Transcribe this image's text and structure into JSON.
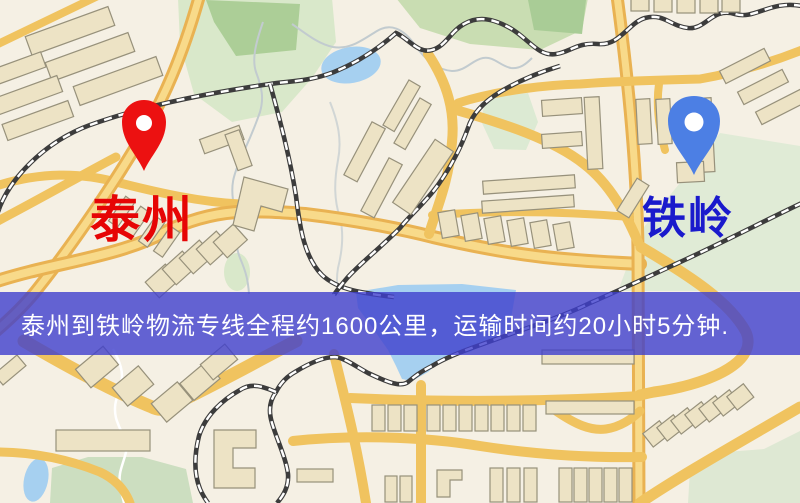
{
  "map": {
    "origin": {
      "label": "泰州",
      "marker": "red-map-pin"
    },
    "destination": {
      "label": "铁岭",
      "marker": "blue-map-pin"
    }
  },
  "banner": {
    "text": "泰州到铁岭物流专线全程约1600公里，运输时间约20小时5分钟.",
    "distance_text": "约1600公里",
    "duration_text": "约20小时5分钟",
    "background": "rgba(62,62,205,0.80)",
    "text_color": "#FFFFFF"
  },
  "colors": {
    "origin_label": "#E60505",
    "destination_label": "#1A1ACC",
    "pin_red": "#EC1111",
    "pin_blue": "#4C7FE4",
    "map_background": "#F5F0E4",
    "road_yellow": "#F0C35F",
    "water_blue": "#A6D0F0",
    "park_green": "#D9E8CA",
    "railway_dark": "#3C3C3C",
    "building_fill": "#EDE3C5"
  }
}
